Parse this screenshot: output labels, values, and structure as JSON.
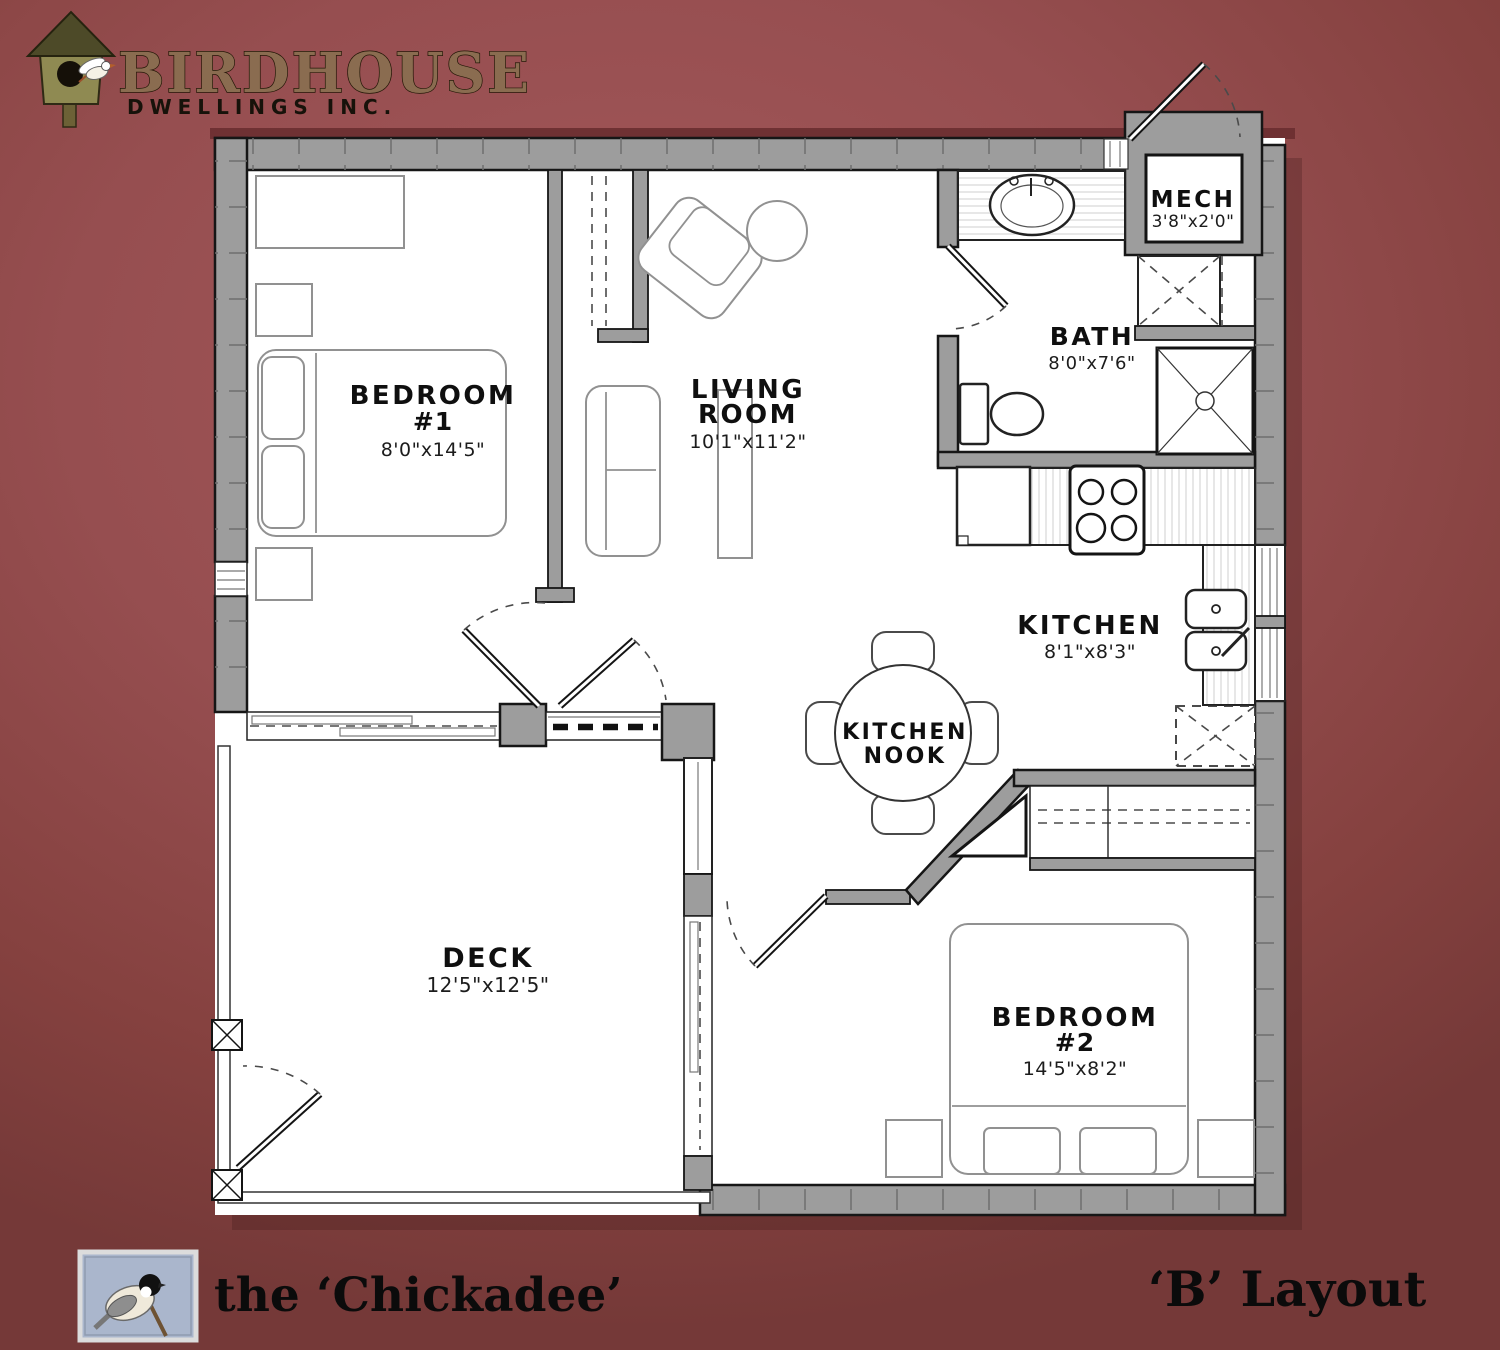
{
  "brand": {
    "name": "BIRDHOUSE",
    "subtitle": "DWELLINGS INC."
  },
  "rooms": {
    "bedroom1": {
      "line1": "BEDROOM",
      "line2": "#1",
      "dims": "8'0\"x14'5\""
    },
    "living": {
      "line1": "LIVING",
      "line2": "ROOM",
      "dims": "10'1\"x11'2\""
    },
    "mech": {
      "label": "MECH",
      "dims": "3'8\"x2'0\""
    },
    "bath": {
      "label": "BATH",
      "dims": "8'0\"x7'6\""
    },
    "kitchen": {
      "label": "KITCHEN",
      "dims": "8'1\"x8'3\""
    },
    "nook": {
      "line1": "KITCHEN",
      "line2": "NOOK"
    },
    "deck": {
      "label": "DECK",
      "dims": "12'5\"x12'5\""
    },
    "bedroom2": {
      "line1": "BEDROOM",
      "line2": "#2",
      "dims": "14'5\"x8'2\""
    }
  },
  "footer": {
    "plan_name": "the ‘Chickadee’",
    "layout_label": "‘B’ Layout"
  },
  "colors": {
    "background": "#964e50",
    "wall_gray": "#9d9d9d",
    "line": "#161616",
    "logo_brown": "#8a6c50"
  }
}
